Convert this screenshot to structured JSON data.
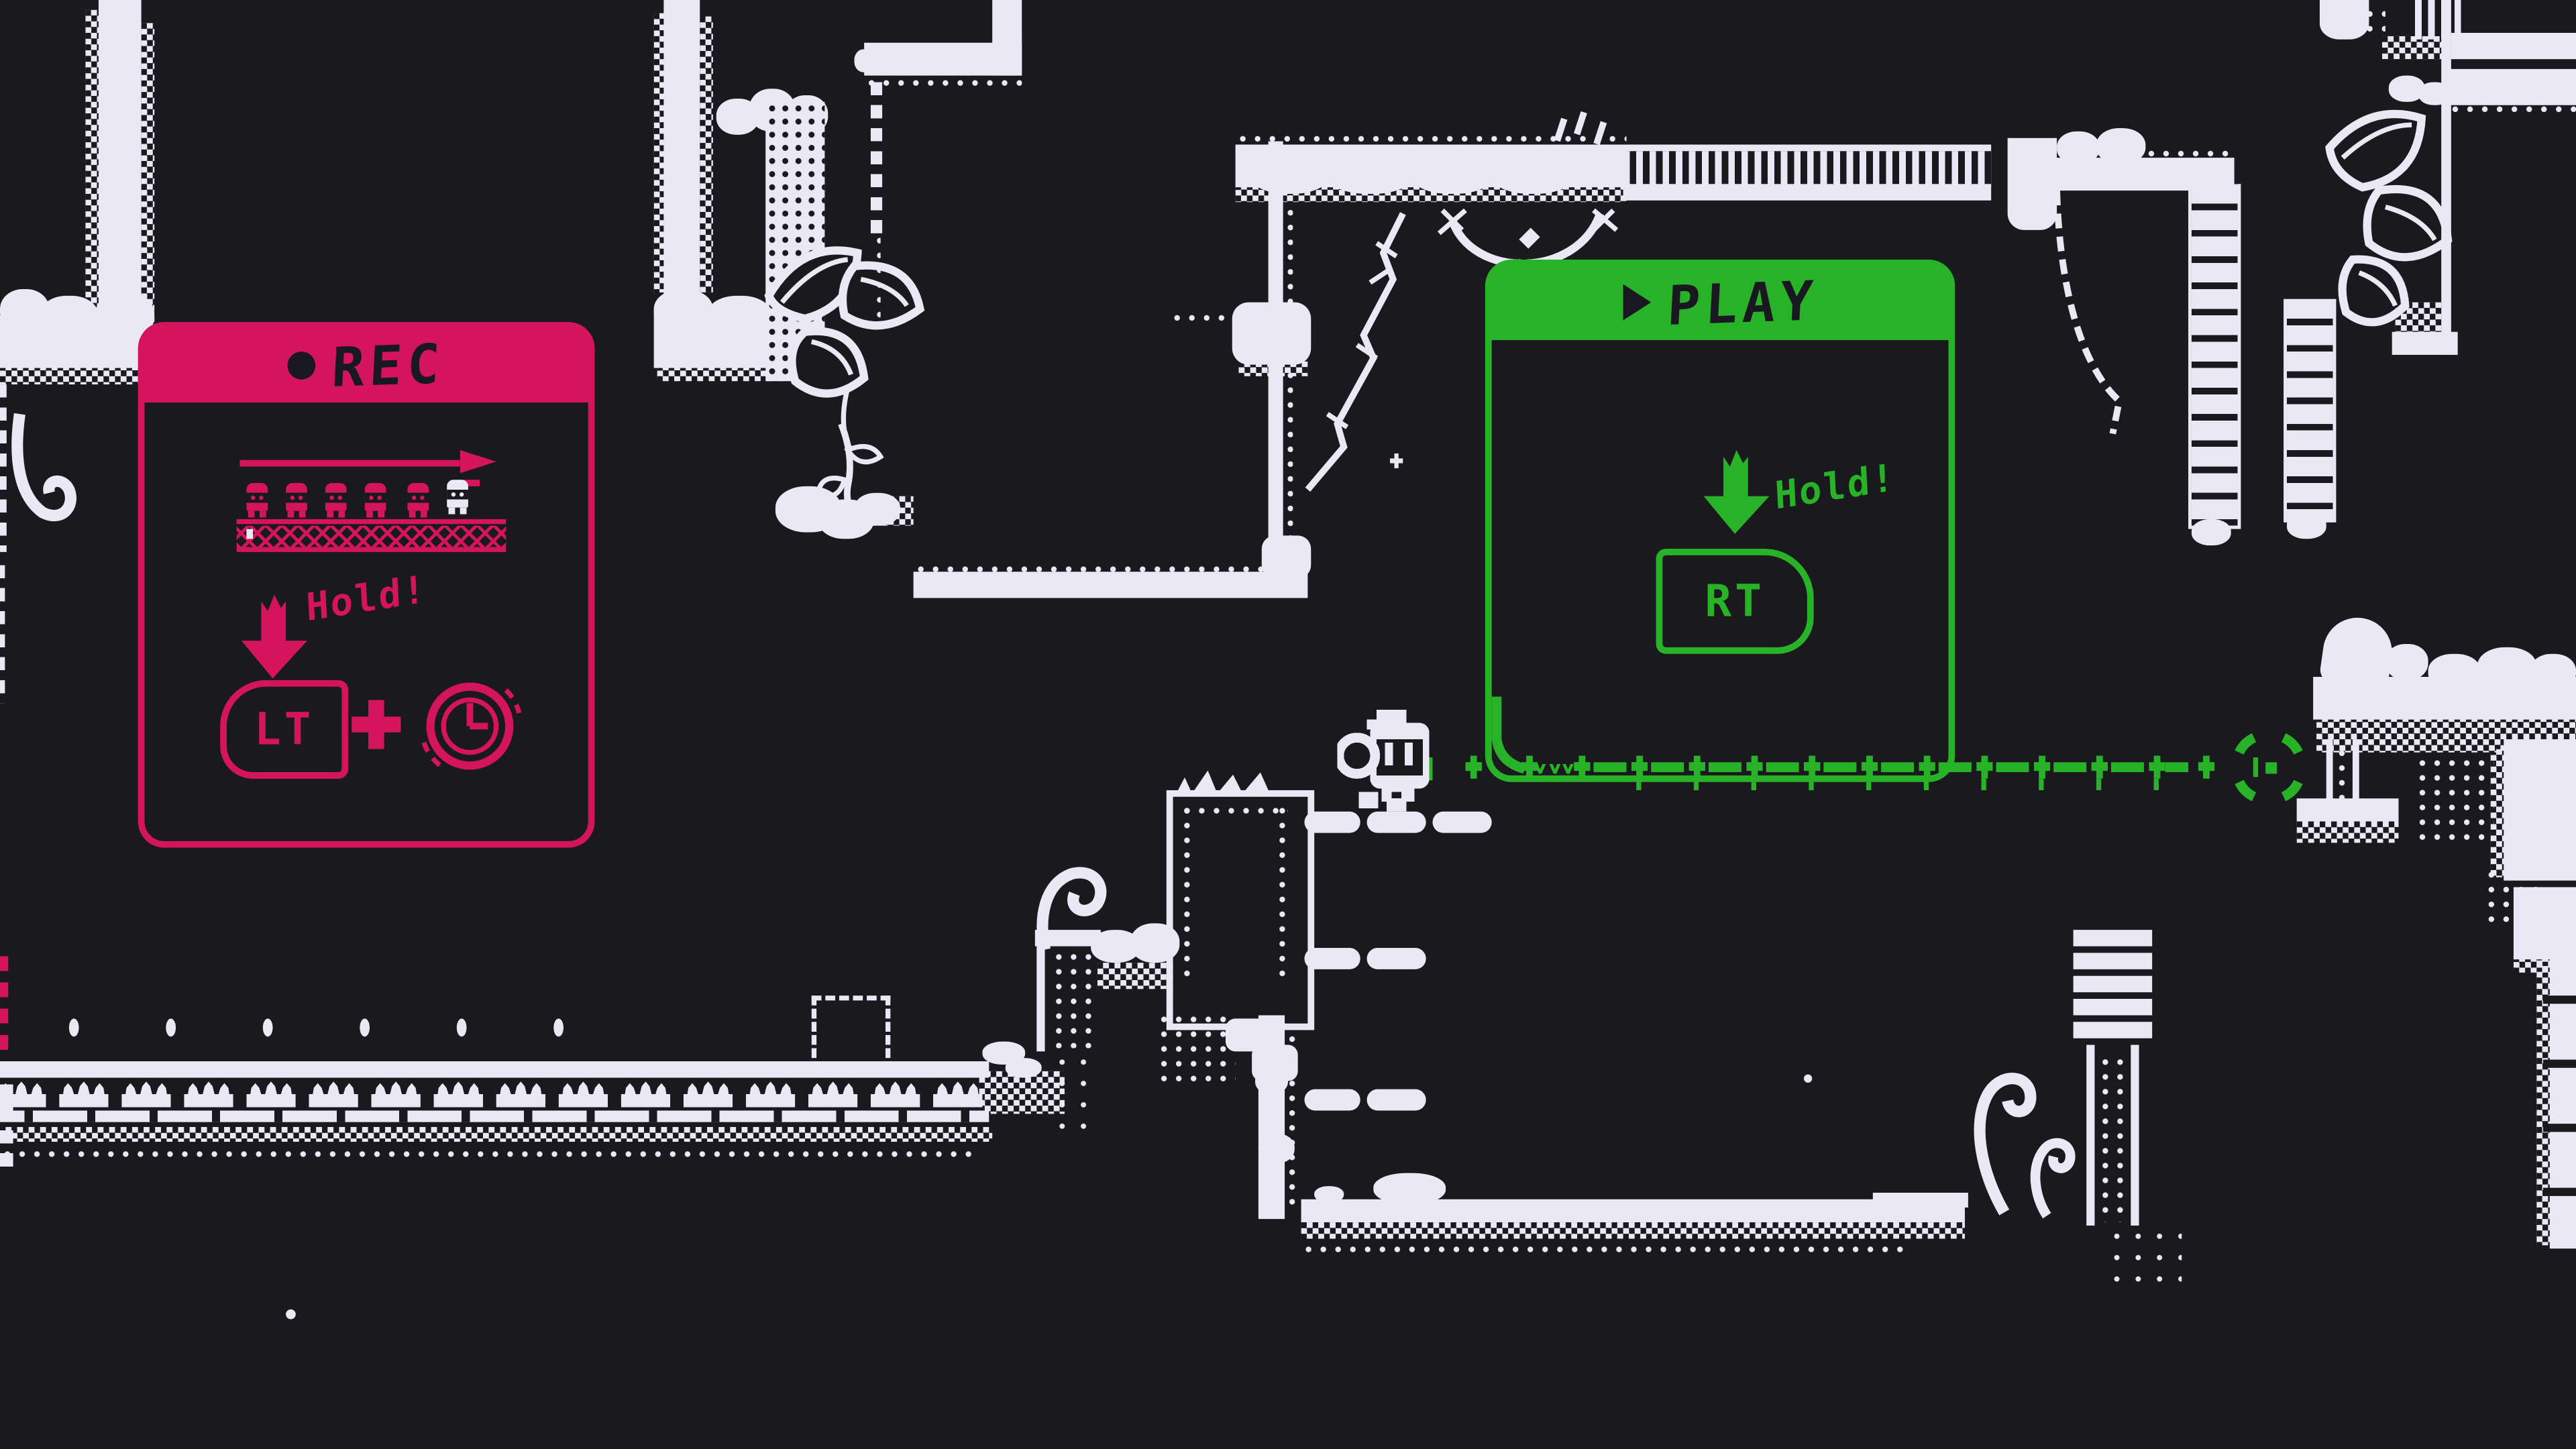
{
  "scene": {
    "background_color": "#1a191d",
    "terrain_color": "#e9e8f4",
    "accent_red": "#d4155b",
    "accent_green": "#28b228",
    "description": "Monochrome pixel-art cave with record/play tutorial popups, robot character, green recorded path and target reticle"
  },
  "rec_panel": {
    "title": "REC",
    "hold_label": "Hold!",
    "trigger_label": "LT",
    "plus_label": "+"
  },
  "play_panel": {
    "title": "PLAY",
    "hold_label": "Hold!",
    "trigger_label": "RT"
  }
}
